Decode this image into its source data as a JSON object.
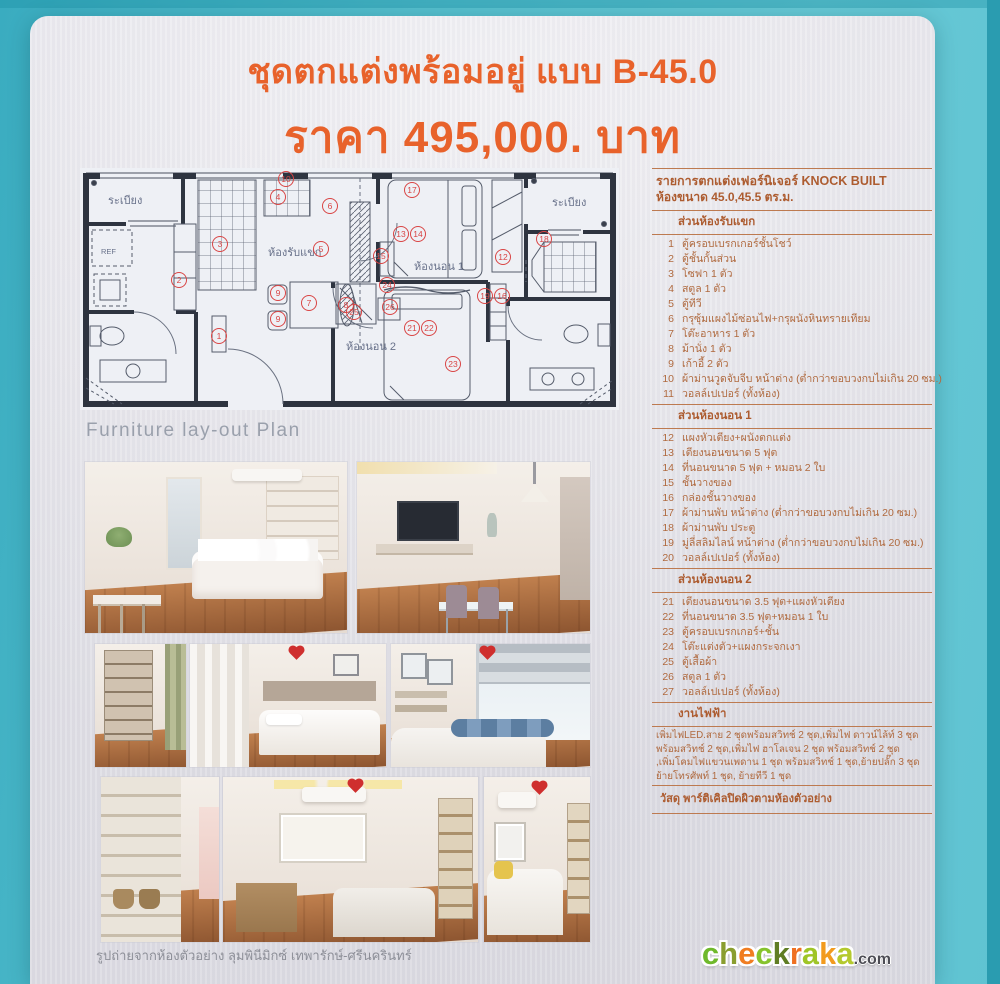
{
  "poster": {
    "title": "ชุดตกแต่งพร้อมอยู่ แบบ B-45.0",
    "price": "ราคา 495,000. บาท"
  },
  "plan": {
    "caption": "Furniture lay-out Plan",
    "labels": {
      "balcony_left": "ระเบียง",
      "living": "ห้องรับแขก",
      "bedroom1": "ห้องนอน 1",
      "balcony_right": "ระเบียง",
      "bedroom2": "ห้องนอน 2",
      "fridge": "REF"
    },
    "marker_color": "#d94545",
    "markers": [
      {
        "n": "10",
        "x": 208,
        "y": 15
      },
      {
        "n": "4",
        "x": 200,
        "y": 33
      },
      {
        "n": "17",
        "x": 334,
        "y": 26
      },
      {
        "n": "6",
        "x": 252,
        "y": 42
      },
      {
        "n": "3",
        "x": 142,
        "y": 80
      },
      {
        "n": "5",
        "x": 243,
        "y": 85
      },
      {
        "n": "13",
        "x": 323,
        "y": 70
      },
      {
        "n": "14",
        "x": 340,
        "y": 70
      },
      {
        "n": "15",
        "x": 303,
        "y": 92
      },
      {
        "n": "12",
        "x": 425,
        "y": 93
      },
      {
        "n": "18",
        "x": 466,
        "y": 75
      },
      {
        "n": "2",
        "x": 101,
        "y": 116
      },
      {
        "n": "9",
        "x": 200,
        "y": 129
      },
      {
        "n": "7",
        "x": 231,
        "y": 139
      },
      {
        "n": "8",
        "x": 268,
        "y": 141
      },
      {
        "n": "9",
        "x": 200,
        "y": 155
      },
      {
        "n": "1",
        "x": 141,
        "y": 172
      },
      {
        "n": "24",
        "x": 309,
        "y": 121
      },
      {
        "n": "26",
        "x": 312,
        "y": 143
      },
      {
        "n": "25",
        "x": 276,
        "y": 148
      },
      {
        "n": "19",
        "x": 407,
        "y": 132
      },
      {
        "n": "16",
        "x": 424,
        "y": 132
      },
      {
        "n": "21",
        "x": 334,
        "y": 164
      },
      {
        "n": "22",
        "x": 351,
        "y": 164
      },
      {
        "n": "23",
        "x": 375,
        "y": 200
      }
    ]
  },
  "list": {
    "header1": "รายการตกแต่งเฟอร์นิเจอร์  KNOCK BUILT",
    "header2": "ห้องขนาด 45.0,45.5 ตร.ม.",
    "sections": [
      {
        "title": "ส่วนห้องรับแขก",
        "items": [
          {
            "no": "1",
            "text": "ตู้ครอบเบรกเกอร์ชั้นโชว์"
          },
          {
            "no": "2",
            "text": "ตู้ชั้นกั้นส่วน"
          },
          {
            "no": "3",
            "text": "โซฟา 1 ตัว"
          },
          {
            "no": "4",
            "text": "สตูล 1 ตัว"
          },
          {
            "no": "5",
            "text": "ตู้ทีวี"
          },
          {
            "no": "6",
            "text": "กรุซุ้มแผงไม้ซ่อนไฟ+กรุผนังหินทรายเทียม"
          },
          {
            "no": "7",
            "text": "โต๊ะอาหาร 1 ตัว"
          },
          {
            "no": "8",
            "text": "ม้านั่ง 1 ตัว"
          },
          {
            "no": "9",
            "text": "เก้าอี้ 2 ตัว"
          },
          {
            "no": "10",
            "text": "ผ้าม่านวูดจับจีบ หน้าต่าง (ต่ำกว่าขอบวงกบไม่เกิน 20 ซม.)"
          },
          {
            "no": "11",
            "text": "วอลล์เปเปอร์ (ทั้งห้อง)"
          }
        ]
      },
      {
        "title": "ส่วนห้องนอน 1",
        "items": [
          {
            "no": "12",
            "text": "แผงหัวเตียง+ผนังตกแต่ง"
          },
          {
            "no": "13",
            "text": "เตียงนอนขนาด 5 ฟุต"
          },
          {
            "no": "14",
            "text": "ที่นอนขนาด 5 ฟุต + หมอน 2 ใบ"
          },
          {
            "no": "15",
            "text": "ชั้นวางของ"
          },
          {
            "no": "16",
            "text": "กล่องชั้นวางของ"
          },
          {
            "no": "17",
            "text": "ผ้าม่านพับ หน้าต่าง (ต่ำกว่าขอบวงกบไม่เกิน 20 ซม.)"
          },
          {
            "no": "18",
            "text": "ผ้าม่านพับ ประตู"
          },
          {
            "no": "19",
            "text": "มู่ลี่สลิมไลน์ หน้าต่าง (ต่ำกว่าขอบวงกบไม่เกิน 20 ซม.)"
          },
          {
            "no": "20",
            "text": "วอลล์เปเปอร์ (ทั้งห้อง)"
          }
        ]
      },
      {
        "title": "ส่วนห้องนอน 2",
        "items": [
          {
            "no": "21",
            "text": "เตียงนอนขนาด 3.5 ฟุต+แผงหัวเตียง"
          },
          {
            "no": "22",
            "text": "ที่นอนขนาด 3.5 ฟุต+หมอน 1 ใบ"
          },
          {
            "no": "23",
            "text": "ตู้ครอบเบรกเกอร์+ชั้น"
          },
          {
            "no": "24",
            "text": "โต๊ะแต่งตัว+แผงกระจกเงา"
          },
          {
            "no": "25",
            "text": "ตู้เสื้อผ้า"
          },
          {
            "no": "26",
            "text": "สตูล 1 ตัว"
          },
          {
            "no": "27",
            "text": "วอลล์เปเปอร์ (ทั้งห้อง)"
          }
        ]
      },
      {
        "title": "งานไฟฟ้า",
        "paragraph": [
          "เพิ่มไฟLED.สาย 2 ชุดพร้อมสวิทช์ 2 ชุด,เพิ่มไฟ ดาวน์ไล้ท์ 3 ชุด",
          "พร้อมสวิทช์ 2 ชุด,เพิ่มไฟ ฮาโลเจน 2 ชุด พร้อมสวิทช์ 2 ชุด",
          ",เพิ่มโคมไฟแขวนเพดาน 1 ชุด พร้อมสวิทช์ 1 ชุด,ย้ายปลั๊ก 3 ชุด",
          "ย้ายโทรศัพท์ 1 ชุด, ย้ายทีวี 1 ชุด"
        ]
      }
    ],
    "material": "วัสดุ พาร์ติเคิลปิดผิวตามห้องตัวอย่าง"
  },
  "photos": {
    "caption": "รูปถ่ายจากห้องตัวอย่าง ลุมพินีมิกซ์ เทพารักษ์-ศรีนครินทร์"
  },
  "logo": {
    "letters": [
      {
        "ch": "c",
        "color": "#6fb92c"
      },
      {
        "ch": "h",
        "color": "#8a9e2f"
      },
      {
        "ch": "e",
        "color": "#f07d21"
      },
      {
        "ch": "c",
        "color": "#86c32d"
      },
      {
        "ch": "k",
        "color": "#5f7d23"
      },
      {
        "ch": "r",
        "color": "#ef7021"
      },
      {
        "ch": "a",
        "color": "#9fc527"
      },
      {
        "ch": "k",
        "color": "#f29b1e"
      },
      {
        "ch": "a",
        "color": "#b4c92e"
      }
    ],
    "suffix": ".com"
  },
  "colors": {
    "accent_orange": "#e8622b",
    "list_text": "#b06a3f",
    "teal_background": "#55bfce",
    "marker_red": "#d94545",
    "plan_wall": "#2e3440"
  }
}
